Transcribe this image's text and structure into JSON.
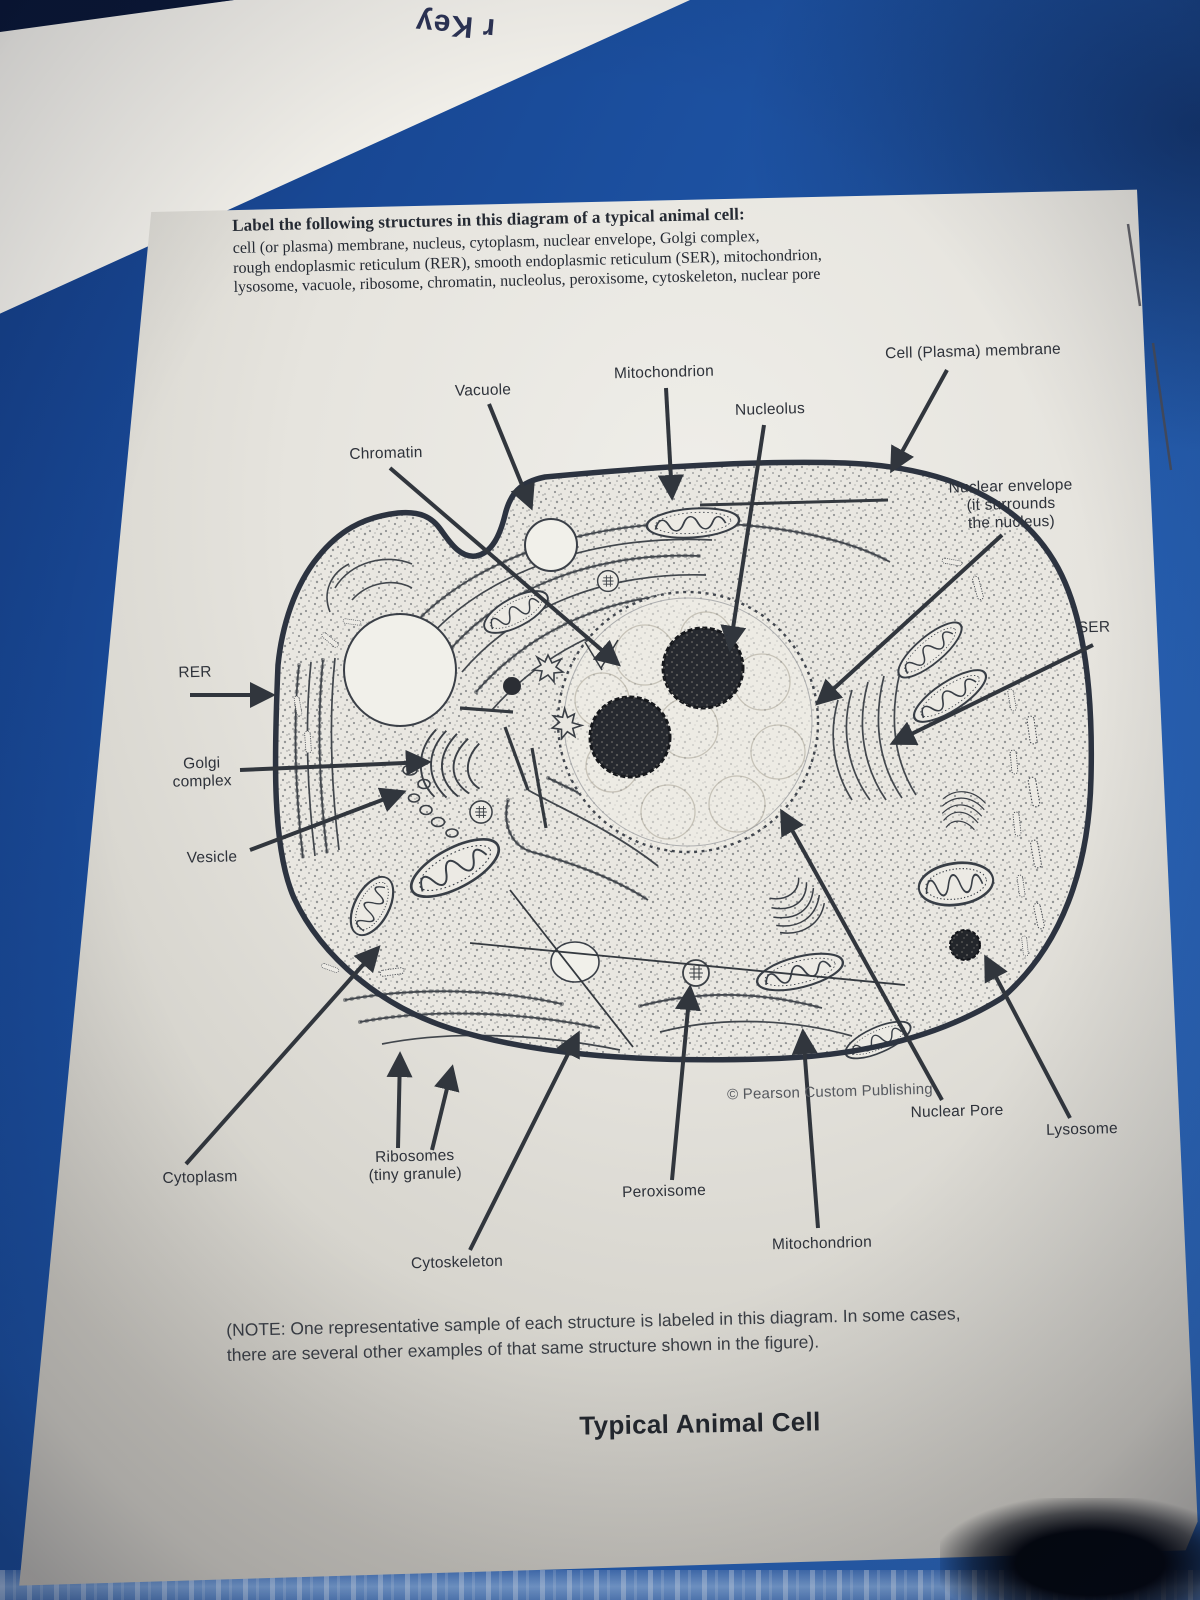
{
  "colors": {
    "desk_blue": "#1d55a8",
    "paper": "#e8e6e0",
    "ink": "#2e333b"
  },
  "background": {
    "key_paper_fragment": "r Key"
  },
  "worksheet": {
    "instructions": {
      "heading": "Label the following structures in this diagram of a typical animal cell:",
      "body_lines": [
        "cell (or plasma) membrane, nucleus, cytoplasm, nuclear envelope, Golgi complex,",
        "rough endoplasmic reticulum (RER), smooth endoplasmic reticulum (SER), mitochondrion,",
        "lysosome, vacuole, ribosome, chromatin, nucleolus, peroxisome, cytoskeleton, nuclear pore"
      ]
    },
    "diagram_labels": {
      "vacuole": "Vacuole",
      "mitochondrion_top": "Mitochondrion",
      "nucleolus": "Nucleolus",
      "cell_membrane": "Cell (Plasma) membrane",
      "chromatin": "Chromatin",
      "nuclear_envelope": "Nuclear envelope\n(it surrounds\nthe nucleus)",
      "ser": "SER",
      "rer": "RER",
      "golgi": "Golgi\ncomplex",
      "vesicle": "Vesicle",
      "cytoplasm": "Cytoplasm",
      "ribosomes": "Ribosomes\n(tiny granule)",
      "cytoskeleton": "Cytoskeleton",
      "peroxisome": "Peroxisome",
      "mitochondrion_bottom": "Mitochondrion",
      "nuclear_pore": "Nuclear Pore",
      "lysosome": "Lysosome"
    },
    "credit": "© Pearson Custom Publishing",
    "note": "(NOTE:  One representative sample of each structure is labeled in this diagram.  In some cases,\nthere are several other examples of that same structure shown in the figure).",
    "title": "Typical Animal Cell"
  }
}
